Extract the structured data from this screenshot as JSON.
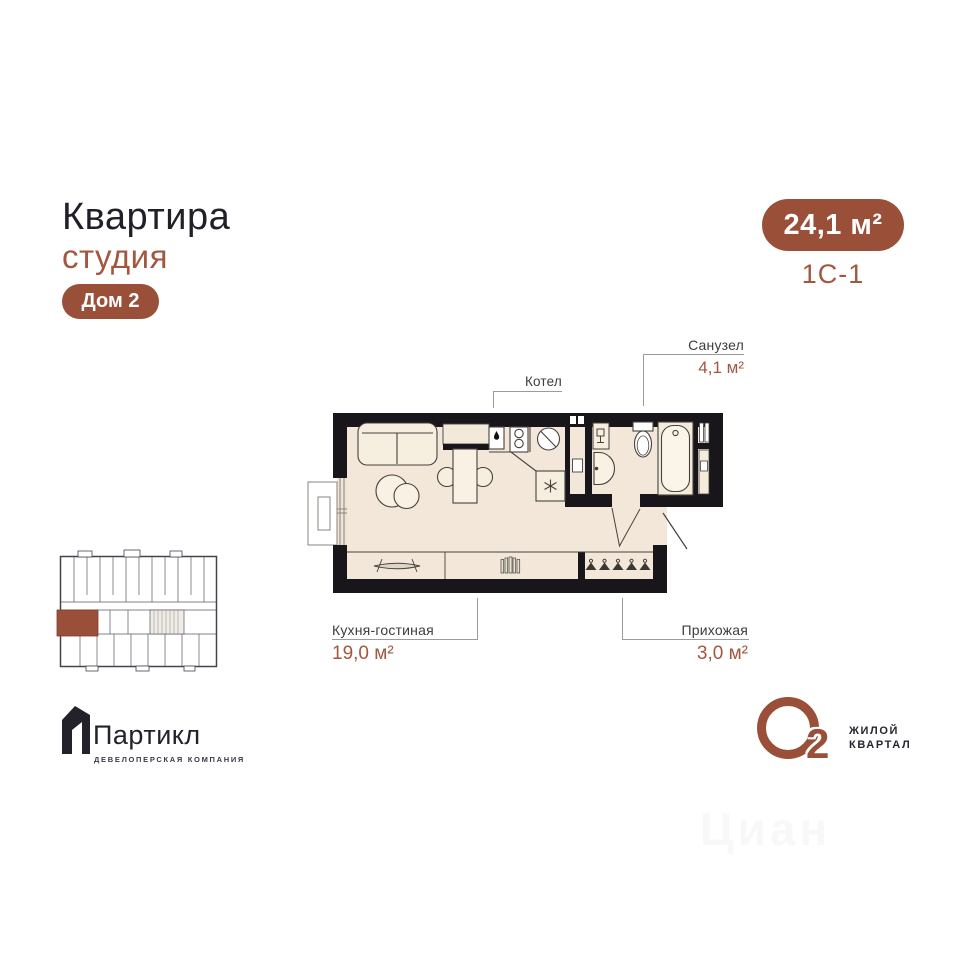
{
  "header": {
    "title": "Квартира",
    "subtitle": "студия",
    "building_badge": "Дом 2"
  },
  "summary": {
    "area_badge": "24,1 м²",
    "unit_code": "1С-1"
  },
  "plan": {
    "labels": {
      "boiler": "Котел",
      "bathroom_name": "Санузел",
      "bathroom_area": "4,1 м²",
      "kitchen_name": "Кухня-гостиная",
      "kitchen_area": "19,0 м²",
      "hallway_name": "Прихожая",
      "hallway_area": "3,0 м²"
    }
  },
  "developer": {
    "name": "Партикл",
    "tagline": "ДЕВЕЛОПЕРСКАЯ КОМПАНИЯ"
  },
  "project": {
    "symbol_letter": "О",
    "symbol_digit": "2",
    "line1": "ЖИЛОЙ",
    "line2": "КВАРТАЛ"
  },
  "watermark": {
    "text": "Циан"
  },
  "colors": {
    "accent": "#9a4f39",
    "accent_text": "#a2573f",
    "wall": "#18161b",
    "floor": "#f2e7d9",
    "title_text": "#211f28",
    "label_text": "#3d3c40"
  }
}
